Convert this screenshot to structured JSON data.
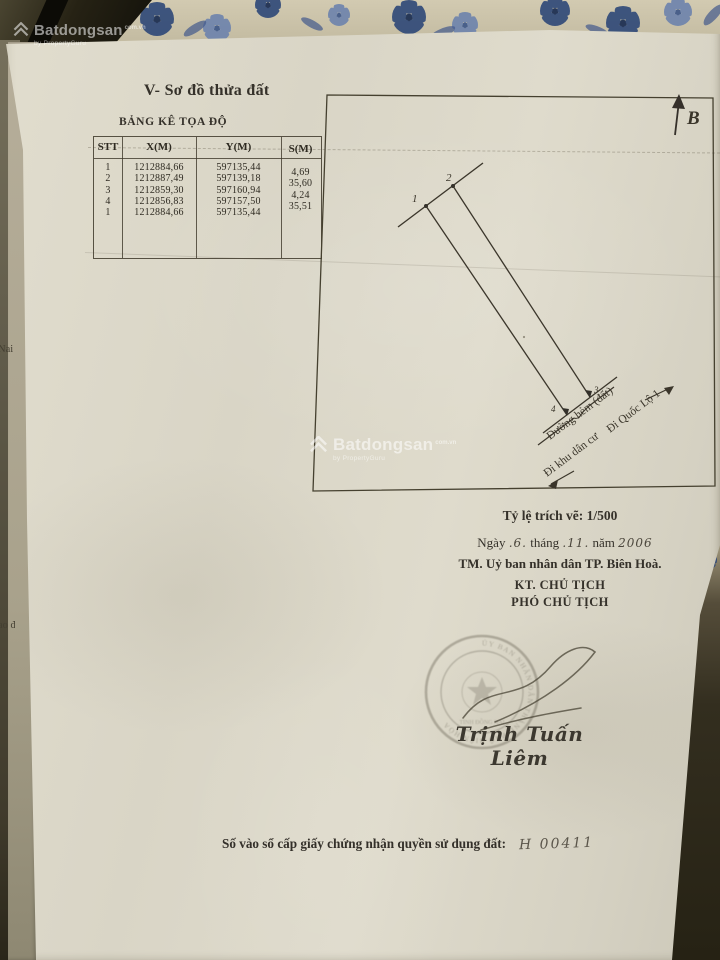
{
  "watermark": {
    "brand": "Batdongsan",
    "domain": "com.vn",
    "sub": "by PropertyGuru"
  },
  "palette": {
    "paper": "#dcd8c9",
    "ink": "#3a362c",
    "fabric_blue": "#2e4878",
    "stamp_ink": "#6e6a5c",
    "background_dark": "#2f2b1e"
  },
  "doc": {
    "section_title": "V- Sơ đồ thửa đất",
    "table": {
      "title": "BẢNG KÊ TỌA ĐỘ",
      "columns": [
        "STT",
        "X(M)",
        "Y(M)",
        "S(M)"
      ],
      "rows": [
        {
          "stt": "1",
          "x": "1212884,66",
          "y": "597135,44"
        },
        {
          "stt": "2",
          "x": "1212887,49",
          "y": "597139,18"
        },
        {
          "stt": "3",
          "x": "1212859,30",
          "y": "597160,94"
        },
        {
          "stt": "4",
          "x": "1212856,83",
          "y": "597157,50"
        },
        {
          "stt": "1",
          "x": "1212884,66",
          "y": "597135,44"
        }
      ],
      "edge_lengths": [
        "4,69",
        "35,60",
        "4,24",
        "35,51"
      ]
    },
    "diagram": {
      "north_label": "B",
      "point_labels": [
        "1",
        "2",
        "3",
        "4"
      ],
      "road_label": "Đường hẻm (đất)",
      "direction_highway": "Đi Quốc Lộ 1",
      "direction_residential": "Đi khu dân cư"
    },
    "scale_note": "Tỷ lệ trích vẽ: 1/500",
    "date_line": {
      "w1": "Ngày",
      "day": ".6.",
      "w2": "tháng",
      "month": ".11.",
      "w3": "năm",
      "year": "2006"
    },
    "issuer": "TM. Uỷ ban nhân dân TP. Biên Hoà.",
    "deputy_for": "KT. CHỦ TỊCH",
    "deputy_title": "PHÓ CHỦ TỊCH",
    "signer_name": "Trịnh Tuấn Liêm",
    "registry_label": "Số vào sổ cấp giấy chứng nhận quyền sử dụng đất:",
    "registry_number": "H 00411",
    "stamp": {
      "ring_text": "ỦY BAN NHÂN DÂN THÀNH PHỐ BIÊN HÒA",
      "ring_text2": "TỈNH ĐỒNG NAI"
    }
  },
  "adjacent_page_fragments": {
    "f1": "Nai",
    "f2": "ao đất"
  }
}
